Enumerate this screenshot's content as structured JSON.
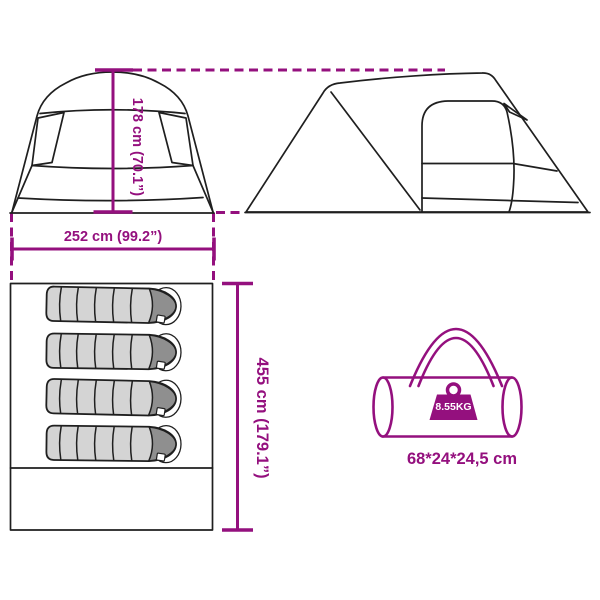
{
  "diagram": {
    "title": "tent-dimensions-diagram",
    "views": {
      "front_view": "tent front elevation with height dimension",
      "side_view": "tent side elevation",
      "floor_plan": "top view with 4 sleeping bags",
      "carry_bag": "packed carry bag with weight badge"
    },
    "colors": {
      "accent": "#94107E",
      "outline": "#1f1f1f",
      "sleeping_bag_body": "#d4d4d4",
      "sleeping_bag_hood": "#8f8f8f",
      "background": "#ffffff"
    }
  },
  "dimensions": {
    "height_label": "178 cm (70.1”)",
    "width_label": "252 cm (99.2”)",
    "length_label": "455 cm (179.1”)"
  },
  "floor_plan": {
    "sleeping_bag_count": 4
  },
  "carry_bag": {
    "weight_label": "8.55KG",
    "size_label": "68*24*24,5 cm"
  }
}
